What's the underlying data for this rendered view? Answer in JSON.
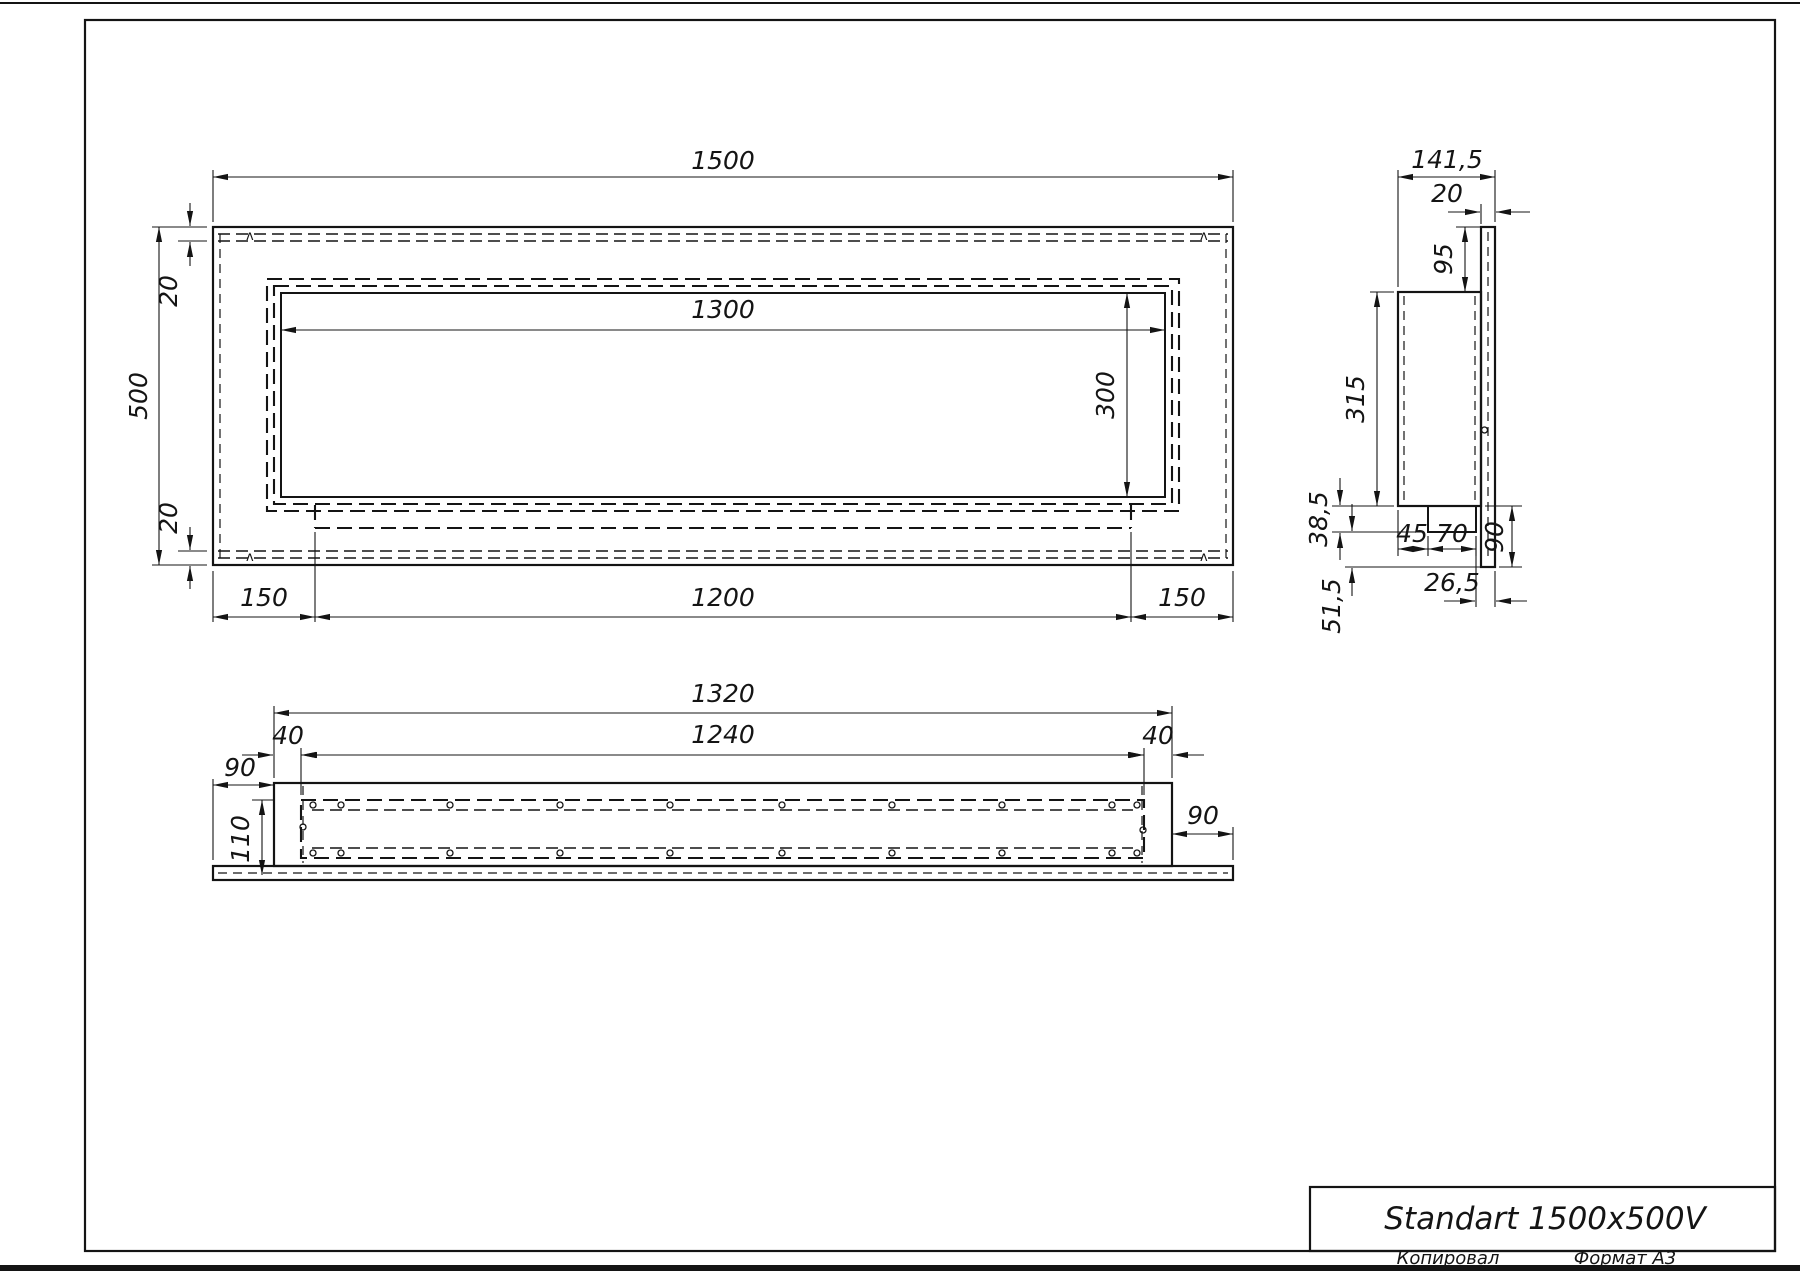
{
  "title_block": {
    "product_name": "Standart 1500x500V",
    "copied_label": "Копировал",
    "format_label": "Формат A3"
  },
  "front_view": {
    "width": "1500",
    "height": "500",
    "top_inset": "20",
    "bottom_inset": "20",
    "opening_width": "1300",
    "opening_height": "300",
    "left_margin": "150",
    "tray_width": "1200",
    "right_margin": "150",
    "corner_mark": "ʌ"
  },
  "side_view": {
    "depth": "141,5",
    "panel_thickness": "20",
    "top_offset": "95",
    "box_height": "315",
    "lip_height": "38,5",
    "lip_inset": "45",
    "lip_width": "70",
    "bottom_offset": "90",
    "lip_depth": "26,5",
    "bottom_gap": "51,5"
  },
  "bottom_view": {
    "body_width": "1320",
    "opening_width": "1240",
    "left_inset": "40",
    "right_inset": "40",
    "left_overhang": "90",
    "right_overhang": "90",
    "inner_depth": "110"
  }
}
